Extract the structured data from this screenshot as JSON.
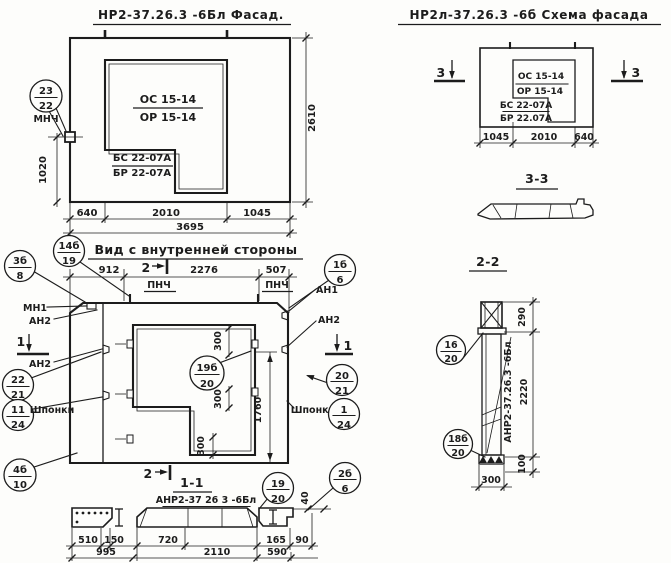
{
  "facade": {
    "title": "НР2-37.26.3 -6Бл Фасад.",
    "window_top_label_1": "ОС 15-14",
    "window_top_label_2": "ОР 15-14",
    "window_bottom_label_1": "БС 22-07А",
    "window_bottom_label_2": "БР 22-07А",
    "marker": {
      "num": "23",
      "sheet": "22",
      "note": "МНЧ"
    },
    "dim_640": "640",
    "dim_2010": "2010",
    "dim_1045": "1045",
    "dim_3695": "3695",
    "dim_2610": "2610",
    "dim_1020": "1020"
  },
  "schema": {
    "title": "НР2л-37.26.3 -6б Схема фасада",
    "window_top_label_1": "ОС 15-14",
    "window_top_label_2": "ОР 15-14",
    "window_bottom_label_1": "БС 22-07А",
    "window_bottom_label_2": "БР 22.07А",
    "dim_1045": "1045",
    "dim_2010": "2010",
    "dim_640": "640",
    "section_mark": "3"
  },
  "section_3_3": {
    "title": "3-3"
  },
  "section_2_2": {
    "title": "2-2",
    "part_label": "АНР2-37.26.3 -6Бл",
    "dim_290": "290",
    "dim_2220": "2220",
    "dim_100": "100",
    "dim_300": "300",
    "marker_top": {
      "num": "16",
      "sheet": "20"
    },
    "marker_bottom": {
      "num": "18б",
      "sheet": "20"
    }
  },
  "inner_view": {
    "title": "Вид с внутренней стороны",
    "dim_912": "912",
    "dim_2276": "2276",
    "dim_507": "507",
    "dim_300": "300",
    "dim_1760": "1760",
    "label_pnch": "ПНЧ",
    "label_mn1": "МН1",
    "label_an1": "АН1",
    "label_an2": "АН2",
    "label_shponki": "Шпонки",
    "mark_1": "1",
    "mark_2": "2",
    "markers": {
      "m14b19": {
        "num": "14б",
        "sheet": "19"
      },
      "m3b8": {
        "num": "3б",
        "sheet": "8"
      },
      "m22_21": {
        "num": "22",
        "sheet": "21"
      },
      "m11_24": {
        "num": "11",
        "sheet": "24"
      },
      "m4b10": {
        "num": "4б",
        "sheet": "10"
      },
      "m1b6": {
        "num": "1б",
        "sheet": "6"
      },
      "m20_21": {
        "num": "20",
        "sheet": "21"
      },
      "m1_24": {
        "num": "1",
        "sheet": "24"
      },
      "m19b20": {
        "num": "19б",
        "sheet": "20"
      }
    }
  },
  "section_1_1": {
    "title": "1-1",
    "part_label": "АНР2-37 26 3 -6Бл",
    "dim_510": "510",
    "dim_150": "150",
    "dim_995": "995",
    "dim_720": "720",
    "dim_2110": "2110",
    "dim_165": "165",
    "dim_90": "90",
    "dim_590": "590",
    "dim_40": "40",
    "marker_19_20": {
      "num": "19",
      "sheet": "20"
    },
    "marker_2b6": {
      "num": "2б",
      "sheet": "6"
    }
  }
}
